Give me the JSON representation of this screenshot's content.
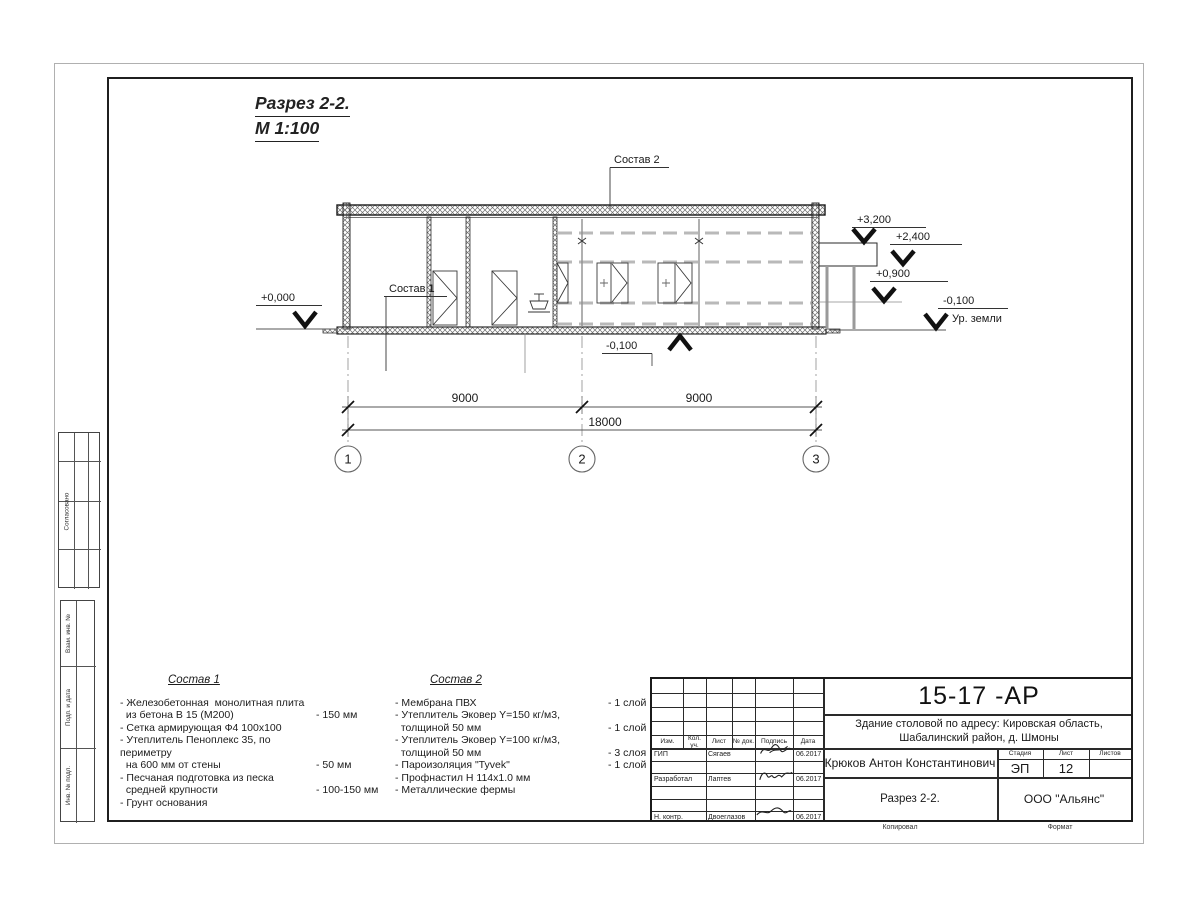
{
  "drawing": {
    "title": "Разрез 2-2.",
    "scale": "М 1:100",
    "callouts": {
      "sostav1": "Состав 1",
      "sostav2": "Состав 2"
    },
    "elevations": {
      "zero": "+0,000",
      "p3200": "+3,200",
      "p2400": "+2,400",
      "p900": "+0,900",
      "m100_bottom": "-0,100",
      "m100_right": "-0,100",
      "ground_label": "Ур. земли"
    },
    "dimensions": {
      "span1": "9000",
      "span2": "9000",
      "total": "18000"
    },
    "axes": [
      "1",
      "2",
      "3"
    ]
  },
  "sostav1": {
    "title": "Состав 1",
    "items": [
      {
        "text": "- Железобетонная  монолитная плита\n  из бетона В 15 (М200)",
        "value": "- 150 мм"
      },
      {
        "text": "- Сетка армирующая Ф4 100х100",
        "value": ""
      },
      {
        "text": "- Утеплитель Пеноплекс 35, по периметру\n  на 600 мм от стены",
        "value": "- 50 мм"
      },
      {
        "text": "- Песчаная подготовка из песка\n  средней крупности",
        "value": "- 100-150 мм"
      },
      {
        "text": "- Грунт основания",
        "value": ""
      }
    ]
  },
  "sostav2": {
    "title": "Состав 2",
    "items": [
      {
        "text": "- Мембрана ПВХ",
        "value": "- 1 слой"
      },
      {
        "text": "- Утеплитель Эковер Y=150 кг/м3,\n  толщиной 50 мм",
        "value": "- 1 слой"
      },
      {
        "text": "- Утеплитель Эковер Y=100 кг/м3,\n  толщиной 50 мм",
        "value": "- 3 слоя"
      },
      {
        "text": "- Пароизоляция \"Tyvek\"",
        "value": "- 1 слой"
      },
      {
        "text": "- Профнастил Н 114х1.0 мм",
        "value": ""
      },
      {
        "text": "- Металлические фермы",
        "value": ""
      }
    ]
  },
  "titleblock": {
    "doc_number": "15-17 -АР",
    "project": "Здание столовой по адресу: Кировская область,\nШабалинский район, д. Шмоны",
    "author": "Крюков Антон Константинович",
    "sheet_title": "Разрез 2-2.",
    "company": "ООО \"Альянс\"",
    "stage_label": "Стадия",
    "sheet_label": "Лист",
    "sheets_label": "Листов",
    "stage": "ЭП",
    "sheet": "12",
    "sheets": "",
    "header": [
      "Изм.",
      "Кол. уч.",
      "Лист",
      "№ док.",
      "Подпись",
      "Дата"
    ],
    "rows": [
      {
        "role": "ГИП",
        "name": "Сягаев",
        "date": "06.2017"
      },
      {
        "role": "Разработал",
        "name": "Лаптев",
        "date": "06.2017"
      },
      {
        "role": "Н. контр.",
        "name": "Двоеглазов",
        "date": "06.2017"
      }
    ]
  },
  "side_stamp": {
    "agreed": "Согласовано",
    "vzam": "Взам. инв. №",
    "podp": "Подп. и дата",
    "inv": "Инв. № подл."
  },
  "footer": {
    "copied": "Копировал",
    "format": "Формат"
  }
}
